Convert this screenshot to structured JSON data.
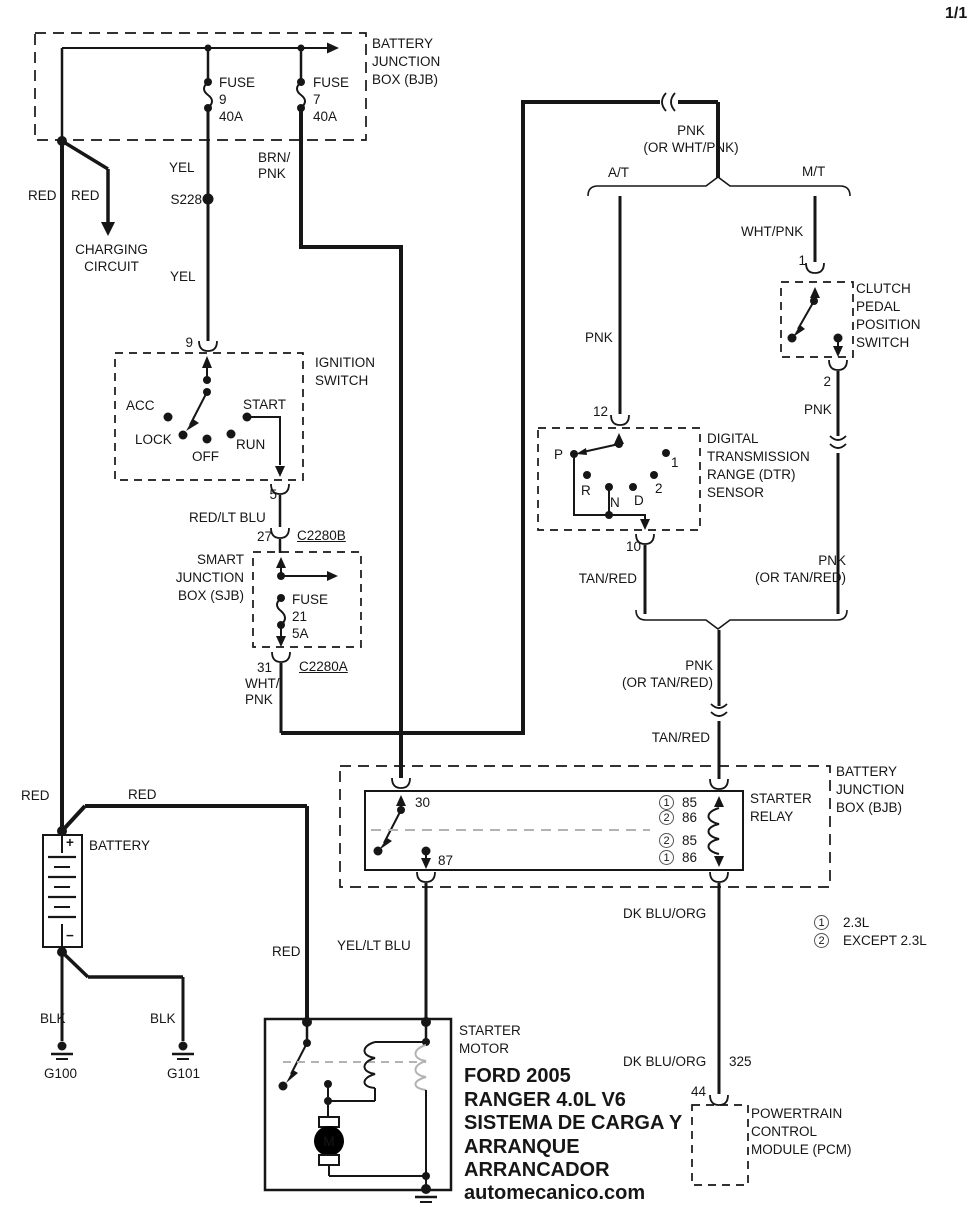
{
  "page_number": "1/1",
  "bjb_top": {
    "title": "BATTERY\nJUNCTION\nBOX (BJB)",
    "fuse9": "FUSE\n9\n40A",
    "fuse7": "FUSE\n7\n40A"
  },
  "wire_labels": {
    "red_left": "RED",
    "red_charging": "RED",
    "charging_circuit": "CHARGING\nCIRCUIT",
    "yel_upper": "YEL",
    "splice": "S228",
    "yel_lower": "YEL",
    "brn_pnk": "BRN/\nPNK",
    "red_lt_blu": "RED/LT BLU",
    "wht_pnk_sjb": "WHT/\nPNK",
    "pnk_or_wht_pnk": "PNK\n(OR WHT/PNK)",
    "wht_pnk_mt": "WHT/PNK",
    "pnk_at": "PNK",
    "pnk_mt": "PNK",
    "pnk_or_tan_red_right": "PNK\n(OR TAN/RED)",
    "tan_red_at": "TAN/RED",
    "pnk_or_tan_red_merge": "PNK\n(OR TAN/RED)",
    "tan_red_merge": "TAN/RED",
    "dk_blu_org_upper": "DK BLU/ORG",
    "dk_blu_org_lower": "DK BLU/ORG",
    "circuit_325": "325",
    "yel_lt_blu": "YEL/LT BLU",
    "red_battery_left": "RED",
    "red_battery_top": "RED",
    "red_to_starter": "RED",
    "blk_g100": "BLK",
    "blk_g101": "BLK"
  },
  "ignition_switch": {
    "pin_in": "9",
    "title": "IGNITION\nSWITCH",
    "acc": "ACC",
    "lock": "LOCK",
    "off": "OFF",
    "run": "RUN",
    "start": "START",
    "pin_out": "5"
  },
  "connectors": {
    "c2280b_pin": "27",
    "c2280b": "C2280B",
    "c2280a_pin": "31",
    "c2280a": "C2280A"
  },
  "sjb": {
    "title": "SMART\nJUNCTION\nBOX (SJB)",
    "fuse21": "FUSE\n21\n5A"
  },
  "branches": {
    "at": "A/T",
    "mt": "M/T"
  },
  "clutch_switch": {
    "pin_in": "1",
    "title": "CLUTCH\nPEDAL\nPOSITION\nSWITCH",
    "pin_out": "2"
  },
  "dtr_sensor": {
    "pin_in": "12",
    "title": "DIGITAL\nTRANSMISSION\nRANGE (DTR)\nSENSOR",
    "p": "P",
    "r": "R",
    "n": "N",
    "d": "D",
    "pos1": "1",
    "pos2": "2",
    "pin_out": "10"
  },
  "bjb_lower": {
    "title": "BATTERY\nJUNCTION\nBOX (BJB)"
  },
  "starter_relay": {
    "title": "STARTER\nRELAY",
    "pin30": "30",
    "pin87": "87",
    "rows": [
      {
        "circ": "1",
        "pin": "85"
      },
      {
        "circ": "2",
        "pin": "86"
      },
      {
        "circ": "2",
        "pin": "85"
      },
      {
        "circ": "1",
        "pin": "86"
      }
    ]
  },
  "legend": [
    {
      "circ": "1",
      "text": "2.3L"
    },
    {
      "circ": "2",
      "text": "EXCEPT 2.3L"
    }
  ],
  "battery": {
    "label": "BATTERY",
    "plus": "+",
    "minus": "−",
    "g100": "G100",
    "g101": "G101"
  },
  "starter_motor": {
    "title": "STARTER\nMOTOR",
    "motor": "M"
  },
  "pcm": {
    "pin": "44",
    "title": "POWERTRAIN\nCONTROL\nMODULE (PCM)"
  },
  "footer": {
    "line1": "FORD 2005",
    "line2": "RANGER 4.0L V6",
    "line3": "SISTEMA DE CARGA Y",
    "line4": "ARRANQUE",
    "line5": "ARRANCADOR",
    "line6": "automecanico.com"
  }
}
